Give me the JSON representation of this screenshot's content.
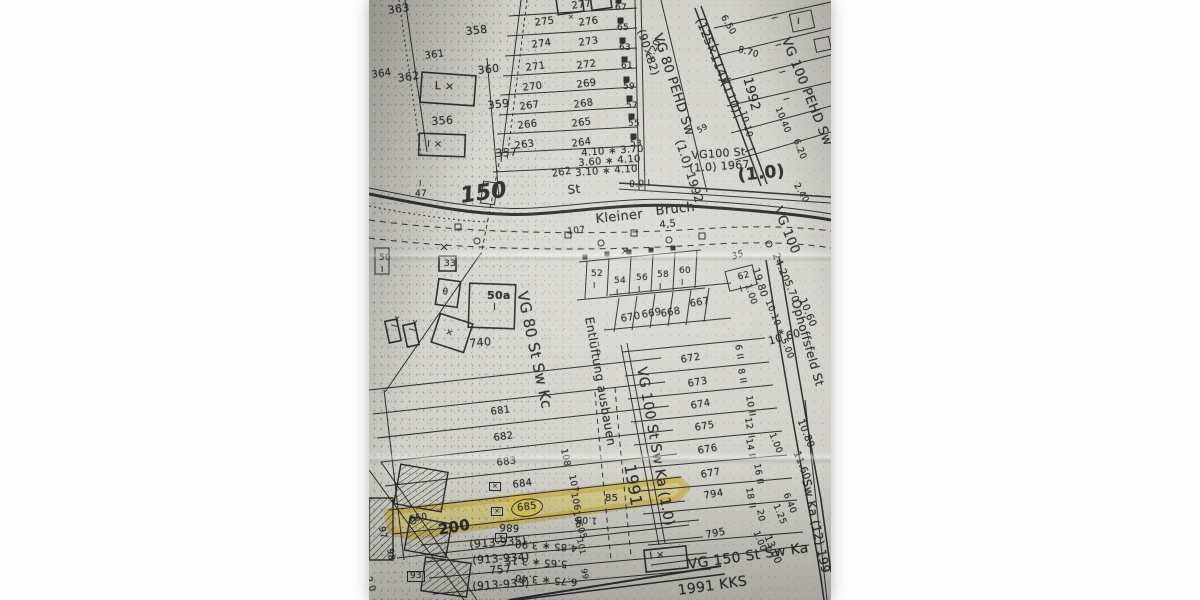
{
  "meta": {
    "kind": "scanned cadastral utility map photograph",
    "highlighted_parcel": "685"
  },
  "colors": {
    "paper": "#d8d7d0",
    "ink": "#1c1c1c",
    "highlight": "#e2c93d",
    "margin": "#fdfdfd"
  },
  "map": {
    "streets": [
      "Kleiner Bruch",
      "Ophoffsfeld St"
    ],
    "pipe_annotations": [
      "VG 80 PEHD Sw (90×82) (1.0) 1992",
      "VG 100 PEHD Sw (125×114)(110) 1992",
      "VG100 St (1.0) 1967",
      "VG 100",
      "VG 80 St Sw Kc",
      "VG 100 St Sw Ka (1.0) 1991",
      "VG 150 St Sw Ka 1991 KKS",
      "Sw Ka (12) 199",
      "Entlüftung ausbauen"
    ],
    "labels": [
      {
        "t": "363",
        "x": 18,
        "y": 5,
        "r": -8,
        "s": 11
      },
      {
        "t": "358",
        "x": 96,
        "y": 26,
        "r": -6,
        "s": 11
      },
      {
        "t": "361",
        "x": 55,
        "y": 52,
        "r": -8,
        "s": 10
      },
      {
        "t": "360",
        "x": 108,
        "y": 65,
        "r": -6,
        "s": 11
      },
      {
        "t": "364",
        "x": 2,
        "y": 71,
        "r": -8,
        "s": 10
      },
      {
        "t": "362",
        "x": 28,
        "y": 73,
        "r": -8,
        "s": 11
      },
      {
        "t": "L ×",
        "x": 66,
        "y": 80,
        "r": 3,
        "s": 11
      },
      {
        "t": "359",
        "x": 118,
        "y": 100,
        "r": -6,
        "s": 11
      },
      {
        "t": "356",
        "x": 62,
        "y": 116,
        "r": -4,
        "s": 11
      },
      {
        "t": "I ×",
        "x": 58,
        "y": 140,
        "r": 0,
        "s": 10
      },
      {
        "t": "357",
        "x": 126,
        "y": 148,
        "r": -4,
        "s": 11
      },
      {
        "t": "I",
        "x": 50,
        "y": 180,
        "r": 0,
        "s": 8
      },
      {
        "t": "47",
        "x": 46,
        "y": 190,
        "r": 0,
        "s": 9
      },
      {
        "t": "150",
        "x": 90,
        "y": 186,
        "r": -8,
        "s": 22,
        "w": 1,
        "it": 1
      },
      {
        "t": "St",
        "x": 198,
        "y": 184,
        "r": -6,
        "s": 12
      },
      {
        "t": "262",
        "x": 182,
        "y": 170,
        "r": -10,
        "s": 10
      },
      {
        "t": "277",
        "x": 202,
        "y": 2,
        "r": -8,
        "s": 10
      },
      {
        "t": "×",
        "x": 199,
        "y": 14,
        "r": 0,
        "s": 7
      },
      {
        "t": "275",
        "x": 165,
        "y": 19,
        "r": -8,
        "s": 10
      },
      {
        "t": "276",
        "x": 209,
        "y": 19,
        "r": -8,
        "s": 10
      },
      {
        "t": "274",
        "x": 162,
        "y": 41,
        "r": -8,
        "s": 10
      },
      {
        "t": "273",
        "x": 209,
        "y": 39,
        "r": -8,
        "s": 10
      },
      {
        "t": "271",
        "x": 156,
        "y": 64,
        "r": -8,
        "s": 10
      },
      {
        "t": "272",
        "x": 207,
        "y": 62,
        "r": -8,
        "s": 10
      },
      {
        "t": "270",
        "x": 153,
        "y": 84,
        "r": -8,
        "s": 10
      },
      {
        "t": "269",
        "x": 207,
        "y": 81,
        "r": -8,
        "s": 10
      },
      {
        "t": "267",
        "x": 150,
        "y": 103,
        "r": -8,
        "s": 10
      },
      {
        "t": "268",
        "x": 204,
        "y": 101,
        "r": -8,
        "s": 10
      },
      {
        "t": "266",
        "x": 148,
        "y": 122,
        "r": -8,
        "s": 10
      },
      {
        "t": "265",
        "x": 202,
        "y": 120,
        "r": -8,
        "s": 10
      },
      {
        "t": "263",
        "x": 145,
        "y": 142,
        "r": -8,
        "s": 10
      },
      {
        "t": "264",
        "x": 202,
        "y": 140,
        "r": -8,
        "s": 10
      },
      {
        "t": "67",
        "x": 246,
        "y": 4,
        "r": 0,
        "s": 9
      },
      {
        "t": "65",
        "x": 248,
        "y": 24,
        "r": 0,
        "s": 9
      },
      {
        "t": "63",
        "x": 250,
        "y": 44,
        "r": 0,
        "s": 9
      },
      {
        "t": "61",
        "x": 252,
        "y": 62,
        "r": 0,
        "s": 9
      },
      {
        "t": "59",
        "x": 254,
        "y": 83,
        "r": 0,
        "s": 9
      },
      {
        "t": "57",
        "x": 257,
        "y": 102,
        "r": 0,
        "s": 9
      },
      {
        "t": "55",
        "x": 259,
        "y": 120,
        "r": 0,
        "s": 9
      },
      {
        "t": "53",
        "x": 261,
        "y": 140,
        "r": 0,
        "s": 9
      },
      {
        "t": "2.20",
        "x": 277,
        "y": 58,
        "r": -65,
        "s": 9
      },
      {
        "t": "4.10 ∗ 3.70",
        "x": 212,
        "y": 149,
        "r": -4,
        "s": 10
      },
      {
        "t": "3.60 ∗ 4.10",
        "x": 209,
        "y": 159,
        "r": -4,
        "s": 10
      },
      {
        "t": "3.10 ∗ 4.10",
        "x": 206,
        "y": 169,
        "r": -4,
        "s": 10
      },
      {
        "t": "0.0 I",
        "x": 260,
        "y": 181,
        "r": -3,
        "s": 9
      },
      {
        "t": "(90×82)",
        "x": 277,
        "y": 28,
        "r": 72,
        "s": 11
      },
      {
        "t": "VG 80 PEHD Sw",
        "x": 294,
        "y": 32,
        "r": 72,
        "s": 13
      },
      {
        "t": "(1.0) 1992",
        "x": 316,
        "y": 138,
        "r": 72,
        "s": 12
      },
      {
        "t": "(125×114)(110)",
        "x": 336,
        "y": 16,
        "r": 68,
        "s": 12
      },
      {
        "t": "1992",
        "x": 384,
        "y": 76,
        "r": 75,
        "s": 13
      },
      {
        "t": "VG 100 PEHD Sw",
        "x": 422,
        "y": 36,
        "r": 68,
        "s": 13
      },
      {
        "t": "6.50",
        "x": 357,
        "y": 14,
        "r": 60,
        "s": 9
      },
      {
        "t": "8.70",
        "x": 370,
        "y": 46,
        "r": 15,
        "s": 9
      },
      {
        "t": "10.10",
        "x": 377,
        "y": 110,
        "r": 75,
        "s": 9
      },
      {
        "t": "10.40",
        "x": 412,
        "y": 106,
        "r": 68,
        "s": 9
      },
      {
        "t": "6.20",
        "x": 430,
        "y": 138,
        "r": 68,
        "s": 9
      },
      {
        "t": "59",
        "x": 327,
        "y": 128,
        "r": -30,
        "s": 8
      },
      {
        "t": "I",
        "x": 408,
        "y": 16,
        "r": 75,
        "s": 8
      },
      {
        "t": "I",
        "x": 412,
        "y": 43,
        "r": 75,
        "s": 8
      },
      {
        "t": "I",
        "x": 416,
        "y": 70,
        "r": 75,
        "s": 8
      },
      {
        "t": "I",
        "x": 420,
        "y": 97,
        "r": 75,
        "s": 8
      },
      {
        "t": "I",
        "x": 428,
        "y": 18,
        "r": 0,
        "s": 9
      },
      {
        "t": "VG100 St",
        "x": 322,
        "y": 150,
        "r": -4,
        "s": 11
      },
      {
        "t": "(1.0) 1967",
        "x": 320,
        "y": 163,
        "r": -4,
        "s": 11
      },
      {
        "t": "(1.0)",
        "x": 368,
        "y": 168,
        "r": -6,
        "s": 17,
        "w": 1
      },
      {
        "t": "2.40",
        "x": 430,
        "y": 182,
        "r": 60,
        "s": 9
      },
      {
        "t": "VG 100",
        "x": 414,
        "y": 205,
        "r": 68,
        "s": 13
      },
      {
        "t": "24.20",
        "x": 410,
        "y": 252,
        "r": 68,
        "s": 10
      },
      {
        "t": "5.70",
        "x": 422,
        "y": 279,
        "r": 68,
        "s": 10
      },
      {
        "t": "10.60",
        "x": 437,
        "y": 297,
        "r": 68,
        "s": 10
      },
      {
        "t": "19.80",
        "x": 390,
        "y": 267,
        "r": 72,
        "s": 10
      },
      {
        "t": "1.00",
        "x": 382,
        "y": 283,
        "r": 72,
        "s": 9
      },
      {
        "t": "10.10 ∗ 5.00",
        "x": 402,
        "y": 299,
        "r": 68,
        "s": 9
      },
      {
        "t": "Kleiner",
        "x": 226,
        "y": 213,
        "r": -6,
        "s": 13
      },
      {
        "t": "Bruch",
        "x": 286,
        "y": 205,
        "r": -6,
        "s": 13
      },
      {
        "t": "4,5",
        "x": 290,
        "y": 221,
        "r": -6,
        "s": 10
      },
      {
        "t": "107",
        "x": 198,
        "y": 228,
        "r": -6,
        "s": 9
      },
      {
        "t": "50",
        "x": 10,
        "y": 254,
        "r": 0,
        "s": 9
      },
      {
        "t": "I",
        "x": 12,
        "y": 266,
        "r": 0,
        "s": 8
      },
      {
        "t": "33",
        "x": 75,
        "y": 260,
        "r": 0,
        "s": 9
      },
      {
        "t": "θ",
        "x": 74,
        "y": 288,
        "r": 8,
        "s": 9
      },
      {
        "t": "50a",
        "x": 118,
        "y": 290,
        "r": 0,
        "s": 11,
        "w": 1
      },
      {
        "t": "I",
        "x": 124,
        "y": 303,
        "r": 0,
        "s": 10
      },
      {
        "t": "740",
        "x": 100,
        "y": 338,
        "r": -5,
        "s": 11
      },
      {
        "t": "×",
        "x": 78,
        "y": 328,
        "r": 20,
        "s": 9
      },
      {
        "t": "I ×",
        "x": 22,
        "y": 326,
        "r": -75,
        "s": 8
      },
      {
        "t": "I ×",
        "x": 40,
        "y": 330,
        "r": -75,
        "s": 8
      },
      {
        "t": "35",
        "x": 362,
        "y": 254,
        "r": -20,
        "s": 9,
        "it": 1
      },
      {
        "t": "52",
        "x": 222,
        "y": 270,
        "r": 0,
        "s": 9
      },
      {
        "t": "I",
        "x": 224,
        "y": 282,
        "r": 0,
        "s": 8
      },
      {
        "t": "54",
        "x": 245,
        "y": 277,
        "r": 0,
        "s": 9
      },
      {
        "t": "I",
        "x": 247,
        "y": 289,
        "r": 0,
        "s": 8
      },
      {
        "t": "56",
        "x": 267,
        "y": 274,
        "r": 0,
        "s": 9
      },
      {
        "t": "I",
        "x": 269,
        "y": 286,
        "r": 0,
        "s": 8
      },
      {
        "t": "58",
        "x": 288,
        "y": 271,
        "r": 0,
        "s": 9
      },
      {
        "t": "I",
        "x": 290,
        "y": 283,
        "r": 0,
        "s": 8
      },
      {
        "t": "60",
        "x": 310,
        "y": 267,
        "r": 0,
        "s": 9
      },
      {
        "t": "I",
        "x": 312,
        "y": 279,
        "r": 0,
        "s": 8
      },
      {
        "t": "62",
        "x": 368,
        "y": 274,
        "r": -15,
        "s": 9
      },
      {
        "t": "I",
        "x": 370,
        "y": 286,
        "r": -15,
        "s": 8
      },
      {
        "t": "667",
        "x": 320,
        "y": 300,
        "r": -10,
        "s": 10
      },
      {
        "t": "668",
        "x": 291,
        "y": 310,
        "r": -10,
        "s": 10
      },
      {
        "t": "669",
        "x": 272,
        "y": 311,
        "r": -10,
        "s": 10
      },
      {
        "t": "670",
        "x": 251,
        "y": 315,
        "r": -10,
        "s": 10
      },
      {
        "t": "Entlüftung ausbauen",
        "x": 226,
        "y": 316,
        "r": 80,
        "s": 12
      },
      {
        "t": "VG 80 St Sw Kc",
        "x": 160,
        "y": 290,
        "r": 78,
        "s": 15
      },
      {
        "t": "VG 100 St Sw Ka (1.0)",
        "x": 279,
        "y": 366,
        "r": 80,
        "s": 14
      },
      {
        "t": "1991",
        "x": 268,
        "y": 463,
        "r": 80,
        "s": 16
      },
      {
        "t": "672",
        "x": 311,
        "y": 356,
        "r": -10,
        "s": 10
      },
      {
        "t": "673",
        "x": 318,
        "y": 380,
        "r": -10,
        "s": 10
      },
      {
        "t": "674",
        "x": 321,
        "y": 402,
        "r": -10,
        "s": 10
      },
      {
        "t": "675",
        "x": 325,
        "y": 424,
        "r": -10,
        "s": 10
      },
      {
        "t": "676",
        "x": 328,
        "y": 447,
        "r": -10,
        "s": 10
      },
      {
        "t": "677",
        "x": 331,
        "y": 471,
        "r": -10,
        "s": 10
      },
      {
        "t": "794",
        "x": 334,
        "y": 492,
        "r": -10,
        "s": 10
      },
      {
        "t": "795",
        "x": 336,
        "y": 531,
        "r": -10,
        "s": 10
      },
      {
        "t": "Ophoffsfeld St",
        "x": 432,
        "y": 298,
        "r": 74,
        "s": 12
      },
      {
        "t": "10.60",
        "x": 398,
        "y": 336,
        "r": -15,
        "s": 11
      },
      {
        "t": "6 II",
        "x": 372,
        "y": 344,
        "r": 80,
        "s": 9
      },
      {
        "t": "8 II",
        "x": 375,
        "y": 368,
        "r": 80,
        "s": 9
      },
      {
        "t": "10 II",
        "x": 383,
        "y": 395,
        "r": 80,
        "s": 9
      },
      {
        "t": "12 II",
        "x": 382,
        "y": 417,
        "r": 80,
        "s": 9
      },
      {
        "t": "14 II",
        "x": 383,
        "y": 438,
        "r": 80,
        "s": 9
      },
      {
        "t": "16 II",
        "x": 391,
        "y": 463,
        "r": 80,
        "s": 9
      },
      {
        "t": "18 II",
        "x": 383,
        "y": 487,
        "r": 80,
        "s": 9
      },
      {
        "t": "20",
        "x": 394,
        "y": 509,
        "r": 80,
        "s": 9
      },
      {
        "t": "10.80",
        "x": 435,
        "y": 418,
        "r": 68,
        "s": 10
      },
      {
        "t": "11.60",
        "x": 431,
        "y": 450,
        "r": 68,
        "s": 10
      },
      {
        "t": "1.00",
        "x": 406,
        "y": 432,
        "r": 68,
        "s": 9
      },
      {
        "t": "6.40",
        "x": 420,
        "y": 492,
        "r": 68,
        "s": 9
      },
      {
        "t": "1.25",
        "x": 410,
        "y": 503,
        "r": 68,
        "s": 9
      },
      {
        "t": "1.00",
        "x": 390,
        "y": 530,
        "r": 68,
        "s": 9
      },
      {
        "t": "13.00",
        "x": 402,
        "y": 534,
        "r": 68,
        "s": 10
      },
      {
        "t": "Sw Ka (12) 199",
        "x": 443,
        "y": 478,
        "r": 78,
        "s": 12
      },
      {
        "t": "681",
        "x": 121,
        "y": 408,
        "r": -8,
        "s": 10
      },
      {
        "t": "682",
        "x": 124,
        "y": 434,
        "r": -8,
        "s": 10
      },
      {
        "t": "683",
        "x": 127,
        "y": 459,
        "r": -8,
        "s": 10
      },
      {
        "t": "×",
        "x": 120,
        "y": 482,
        "r": 0,
        "s": 7,
        "box": 1
      },
      {
        "t": "684",
        "x": 143,
        "y": 481,
        "r": -8,
        "s": 10
      },
      {
        "t": "×",
        "x": 122,
        "y": 507,
        "r": 0,
        "s": 7,
        "box": 1
      },
      {
        "t": "685",
        "x": 141,
        "y": 501,
        "r": -8,
        "s": 10,
        "circ": 1
      },
      {
        "t": "×",
        "x": 126,
        "y": 533,
        "r": 0,
        "s": 7,
        "box": 1
      },
      {
        "t": "686",
        "x": 150,
        "y": 532,
        "r": 183,
        "s": 10
      },
      {
        "t": "200",
        "x": 68,
        "y": 523,
        "r": -10,
        "s": 15,
        "w": 1
      },
      {
        "t": "650",
        "x": 40,
        "y": 516,
        "r": -10,
        "s": 9
      },
      {
        "t": "97",
        "x": 16,
        "y": 526,
        "r": 80,
        "s": 9
      },
      {
        "t": "98",
        "x": 24,
        "y": 548,
        "r": 80,
        "s": 9
      },
      {
        "t": "93",
        "x": 38,
        "y": 571,
        "r": 0,
        "s": 9,
        "box": 1
      },
      {
        "t": "2.0",
        "x": 2,
        "y": 576,
        "r": 70,
        "s": 9
      },
      {
        "t": "(913-935)",
        "x": 100,
        "y": 539,
        "r": -4,
        "s": 11
      },
      {
        "t": "(913-934)",
        "x": 103,
        "y": 555,
        "r": -4,
        "s": 11
      },
      {
        "t": "757",
        "x": 120,
        "y": 565,
        "r": -4,
        "s": 11
      },
      {
        "t": "(913-933)",
        "x": 103,
        "y": 581,
        "r": -4,
        "s": 11
      },
      {
        "t": "4.85 ∗ 3.90",
        "x": 208,
        "y": 552,
        "r": 184,
        "s": 10
      },
      {
        "t": "5.65 ∗ 3.15",
        "x": 198,
        "y": 568,
        "r": 184,
        "s": 10
      },
      {
        "t": "6.75 ∗ 3.40",
        "x": 208,
        "y": 586,
        "r": 184,
        "s": 10
      },
      {
        "t": "I ×",
        "x": 280,
        "y": 552,
        "r": -6,
        "s": 10
      },
      {
        "t": "VG 150 St Sw Ka",
        "x": 318,
        "y": 558,
        "r": -8,
        "s": 14
      },
      {
        "t": "1991  KKS",
        "x": 308,
        "y": 584,
        "r": -8,
        "s": 14
      },
      {
        "t": "108",
        "x": 198,
        "y": 448,
        "r": 78,
        "s": 9
      },
      {
        "t": "107",
        "x": 206,
        "y": 474,
        "r": 78,
        "s": 9
      },
      {
        "t": "106",
        "x": 208,
        "y": 492,
        "r": 78,
        "s": 9
      },
      {
        "t": "105",
        "x": 210,
        "y": 510,
        "r": 78,
        "s": 9
      },
      {
        "t": "85",
        "x": 236,
        "y": 494,
        "r": 0,
        "s": 10
      },
      {
        "t": "4.05",
        "x": 211,
        "y": 518,
        "r": 70,
        "s": 9
      },
      {
        "t": "1.05",
        "x": 228,
        "y": 524,
        "r": 184,
        "s": 9
      },
      {
        "t": "101",
        "x": 214,
        "y": 538,
        "r": 78,
        "s": 8
      },
      {
        "t": "99",
        "x": 218,
        "y": 568,
        "r": 78,
        "s": 8
      }
    ]
  }
}
